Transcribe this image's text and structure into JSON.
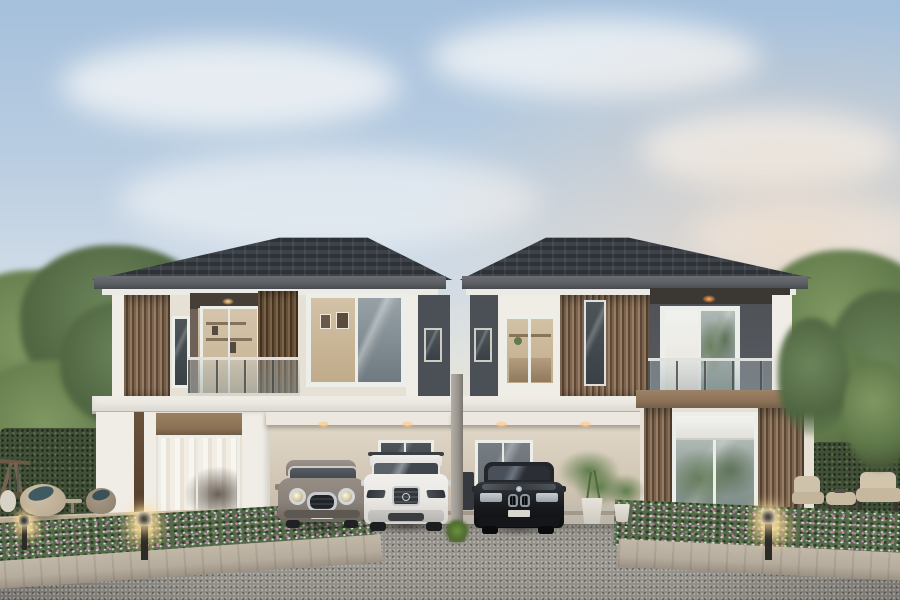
{
  "meta": {
    "type": "architectural-exterior-render",
    "subject": "Twin two-storey duplex houses with carports, three parked cars, landscaped gardens and bollard lamps at dusk",
    "canvas": {
      "width": 900,
      "height": 600
    }
  },
  "palette": {
    "skyTop": "#a5c0dc",
    "roof": "#2e3237",
    "roofFascia": "#5b5e63",
    "soffit": "#eceae4",
    "wallCream": "#e7e1d5",
    "wallWhite": "#f0ede6",
    "wallDark": "#4b4f56",
    "wood": "#7c6450",
    "brownBand": "#8d7258",
    "valance": "#8a7257",
    "slab": "#efece5",
    "interiorWarm": "#d3c2a6",
    "glassCool": "#7f8a90",
    "carportWall": "#d6cbba",
    "concrete": "#b9b2a6",
    "driveway": "#93908a",
    "curb": "#b6ac9d",
    "hedge": "#414f38",
    "tree": "#5f7849",
    "flowers": "#55684a",
    "lampGlow": "#ffe4a5",
    "post": "#9b9790",
    "carMini": "#8a8279",
    "carVolvo": "#e9e7e3",
    "carBmw": "#17191c",
    "cushion": "#3e5a63",
    "deck": "#a4937c",
    "pot": "#e6e3db",
    "plant": "#5f7c4a",
    "curtain": "#e9e4da"
  },
  "scene": {
    "sky": {
      "description": "pale blue sky, soft clouds, warm sunset tint on the right",
      "clouds": 5
    },
    "houses": [
      {
        "id": "left-house",
        "roof": "dark hipped tile roof",
        "features": [
          "vertical wood-slat cladding",
          "balcony with glass balustrade and slatted slider",
          "large upper window with art inside",
          "glass door with brown roller valance",
          "double carport with downlights"
        ]
      },
      {
        "id": "right-house",
        "roof": "dark hipped tile roof",
        "features": [
          "corner window with lit interior",
          "wood-slat cladding with glazed strip",
          "balcony with glass balustrade",
          "single carport with downlights",
          "slat-framed living-room window with roller shade"
        ]
      }
    ],
    "cars": [
      {
        "id": "mini-hatchback",
        "color_name": "warm grey",
        "position": "left carport"
      },
      {
        "id": "white-suv",
        "color_name": "white",
        "position": "left carport"
      },
      {
        "id": "black-sedan",
        "color_name": "black",
        "position": "right carport"
      }
    ],
    "landscaping": {
      "bollard_lamps": 3,
      "flower_beds": 2,
      "hedges": 2,
      "trees": "both sides",
      "potted_palms": 2,
      "grass_tuft": "base of centre post"
    },
    "furniture": {
      "left_patio": [
        "wooden swing frame",
        "two pod lounge chairs with teal cushions",
        "side table"
      ],
      "right_patio": [
        "two cushioned armchairs",
        "ottoman table"
      ]
    }
  }
}
